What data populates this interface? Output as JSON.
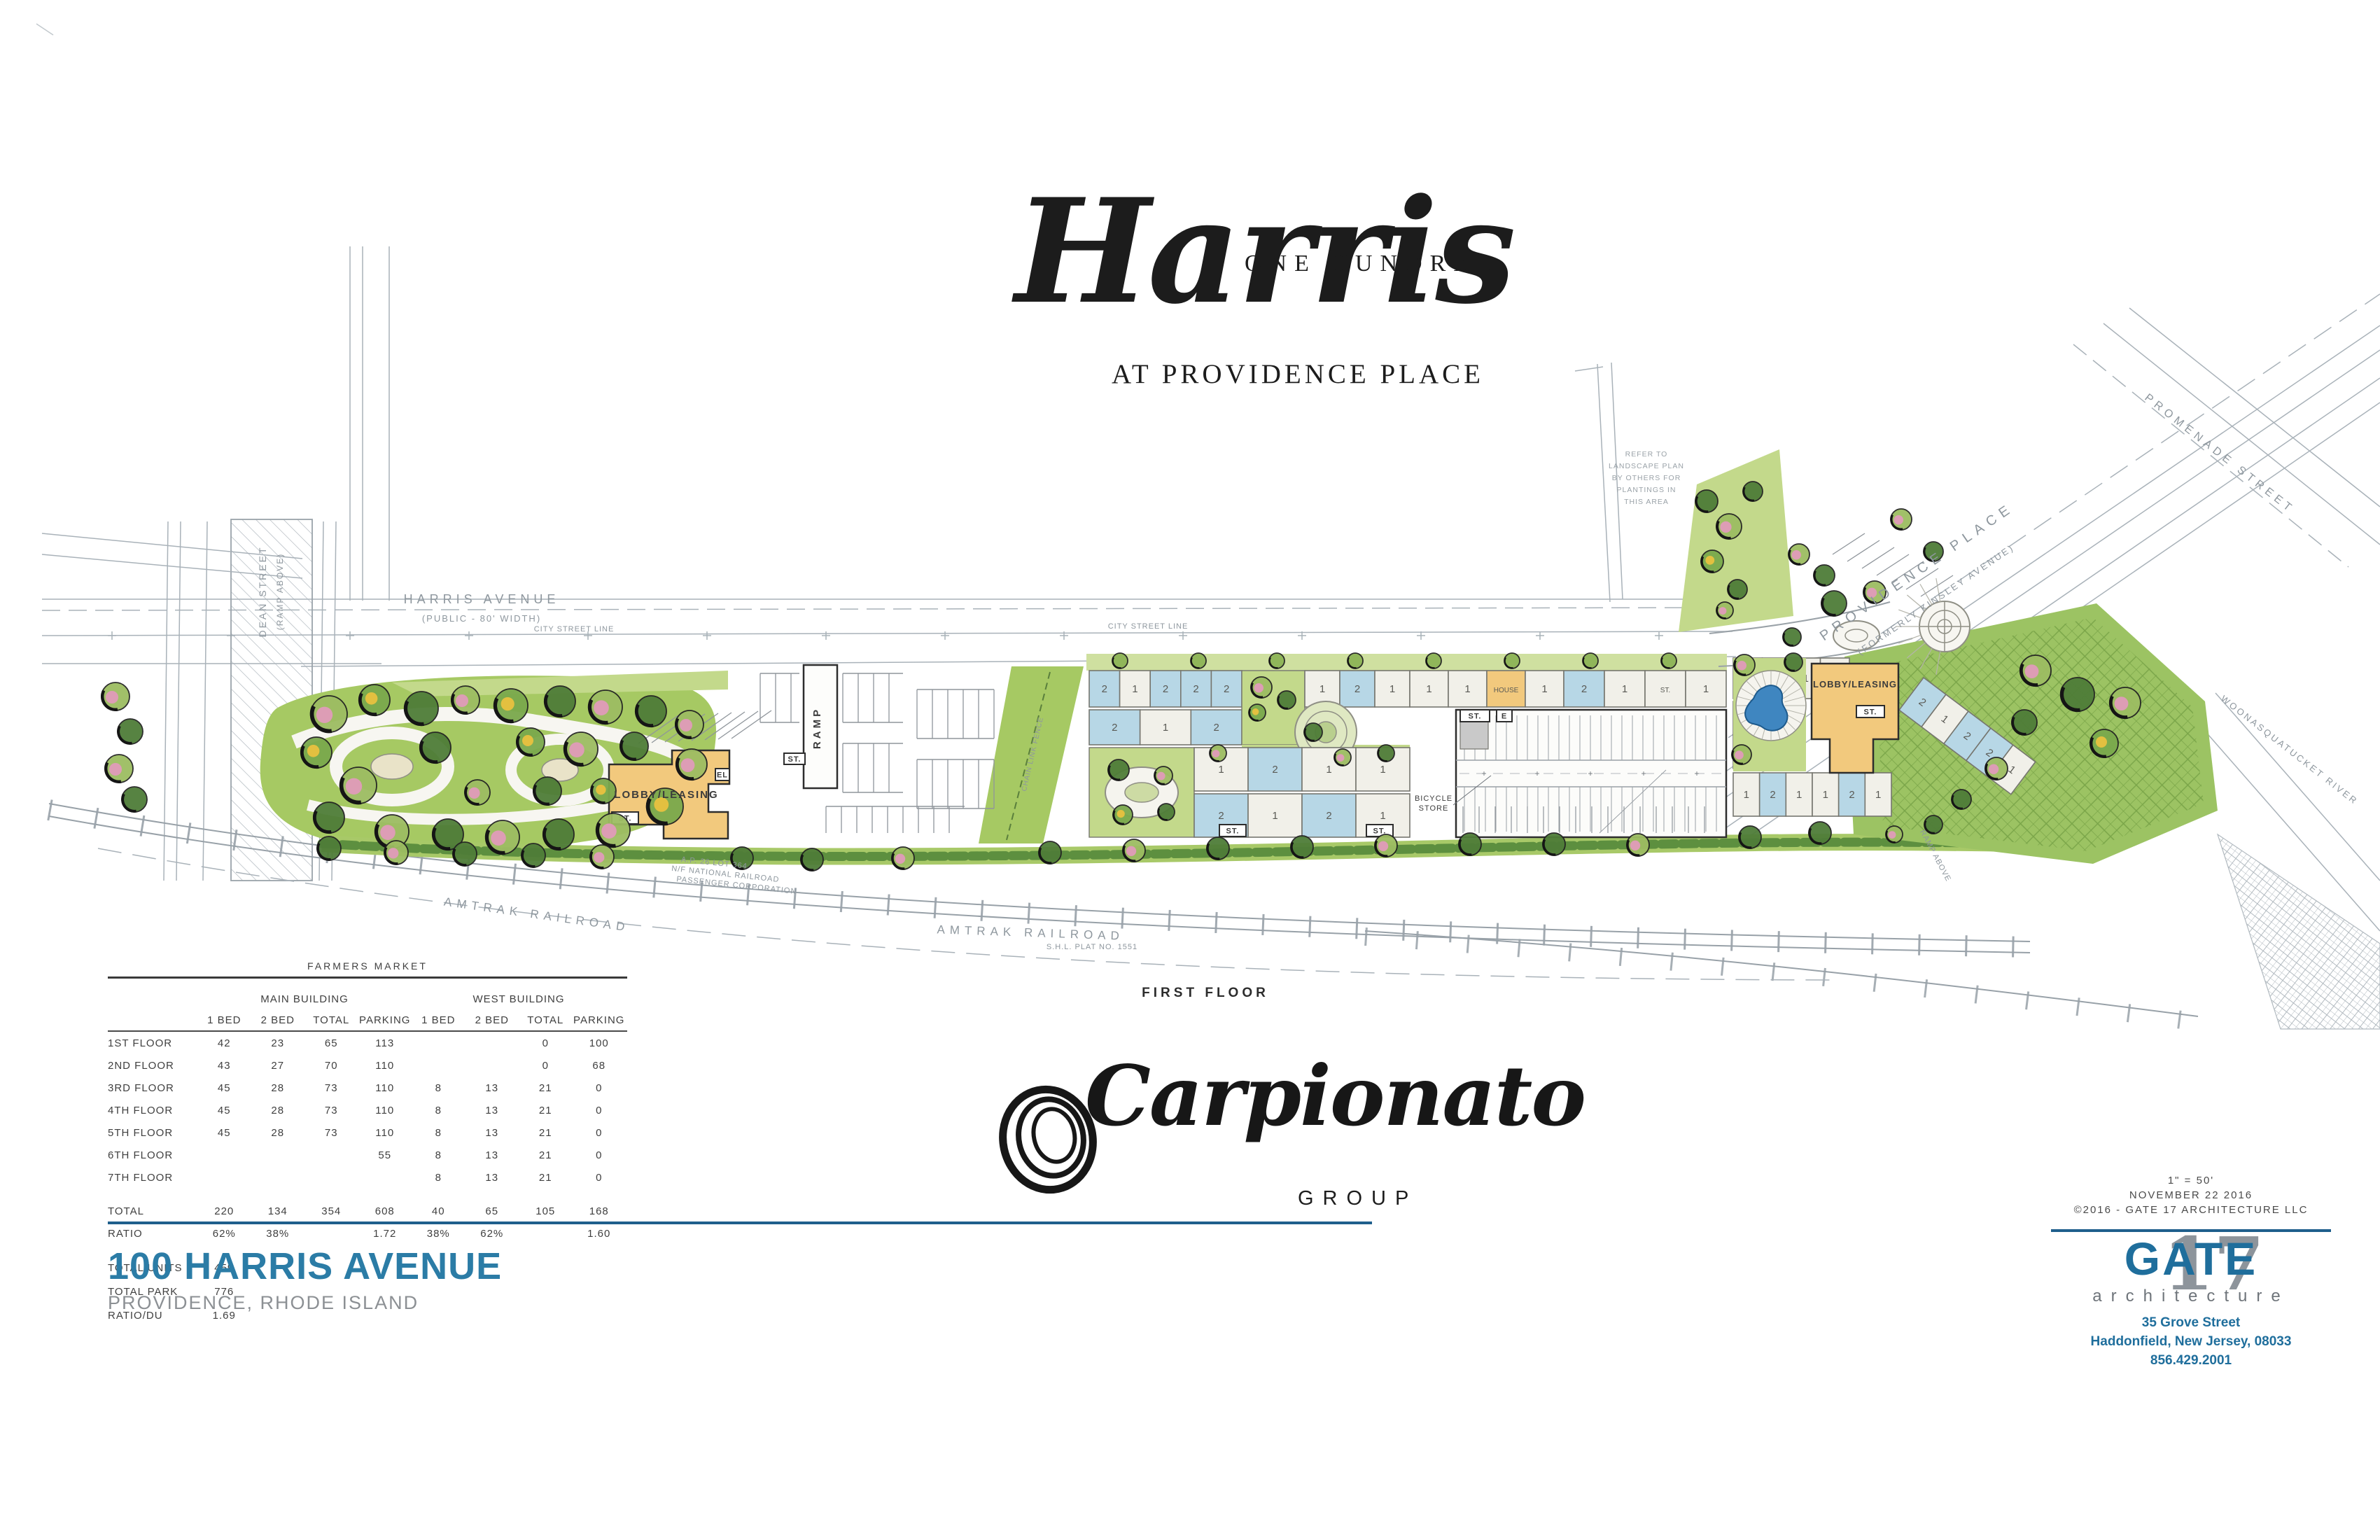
{
  "title": {
    "pre": "ONE HUNDRED",
    "main": "Harris",
    "sub": "AT PROVIDENCE PLACE"
  },
  "plan_labels": {
    "harris_avenue": "HARRIS AVENUE",
    "harris_avenue_sub": "(PUBLIC - 80' WIDTH)",
    "city_street_line": "CITY STREET LINE",
    "dean_street": "DEAN STREET",
    "dean_street_sub": "(RAMP ABOVE)",
    "providence_place": "PROVIDENCE PLACE",
    "providence_place_sub": "(FORMERLY KINSLEY AVENUE)",
    "promenade_street": "PROMENADE STREET",
    "woonasquatucket": "WOONASQUATUCKET RIVER",
    "amtrak_railroad": "AMTRAK RAILROAD",
    "railroad_lot": "A.P. 26 LOT 364",
    "railroad_owner1": "N/F NATIONAL RAILROAD",
    "railroad_owner2": "PASSENGER CORPORATION",
    "shl_plat": "S.H.L. PLAT NO. 1551",
    "chain_link_fence": "CHAIN LINK FENCE",
    "ramp_above": "RAMP ABOVE",
    "lobby_leasing": "LOBBY/LEASING",
    "ramp": "RAMP",
    "house": "HOUSE",
    "bicycle1": "BICYCLE",
    "bicycle2": "STORE",
    "st": "ST.",
    "el": "EL",
    "e": "E",
    "first_floor": "FIRST FLOOR",
    "landscape_note": [
      "REFER TO",
      "LANDSCAPE PLAN",
      "BY OTHERS FOR",
      "PLANTINGS IN",
      "THIS AREA"
    ]
  },
  "units": {
    "rowA": [
      "2",
      "1",
      "2",
      "2",
      "2"
    ],
    "rowB": [
      "1",
      "2",
      "1"
    ],
    "row2": [
      "2",
      "1",
      "2"
    ],
    "rowC": [
      "1",
      "1",
      "HOUSE",
      "1"
    ],
    "rowD": [
      "2",
      "1",
      "ST.",
      "1"
    ],
    "center_upper": [
      "1",
      "2",
      "1",
      "1"
    ],
    "center_lower": [
      "2",
      "1",
      "2",
      "1"
    ],
    "west_top": [
      "1",
      "2",
      "1",
      "1"
    ],
    "west_left": [
      "2",
      "1"
    ],
    "west_bottom": [
      "1",
      "2",
      "1",
      "1",
      "2",
      "1"
    ],
    "west_diag": [
      "2",
      "1",
      "2",
      "2",
      "1"
    ]
  },
  "unit_table": {
    "title": "FARMERS MARKET",
    "groups": [
      "MAIN BUILDING",
      "WEST BUILDING"
    ],
    "columns": [
      "1 BED",
      "2 BED",
      "TOTAL",
      "PARKING"
    ],
    "rows": [
      {
        "label": "1ST FLOOR",
        "main": [
          "42",
          "23",
          "65",
          "113"
        ],
        "west": [
          "",
          "",
          "0",
          "100"
        ]
      },
      {
        "label": "2ND FLOOR",
        "main": [
          "43",
          "27",
          "70",
          "110"
        ],
        "west": [
          "",
          "",
          "0",
          "68"
        ]
      },
      {
        "label": "3RD FLOOR",
        "main": [
          "45",
          "28",
          "73",
          "110"
        ],
        "west": [
          "8",
          "13",
          "21",
          "0"
        ]
      },
      {
        "label": "4TH FLOOR",
        "main": [
          "45",
          "28",
          "73",
          "110"
        ],
        "west": [
          "8",
          "13",
          "21",
          "0"
        ]
      },
      {
        "label": "5TH FLOOR",
        "main": [
          "45",
          "28",
          "73",
          "110"
        ],
        "west": [
          "8",
          "13",
          "21",
          "0"
        ]
      },
      {
        "label": "6TH FLOOR",
        "main": [
          "",
          "",
          "",
          "55"
        ],
        "west": [
          "8",
          "13",
          "21",
          "0"
        ]
      },
      {
        "label": "7TH FLOOR",
        "main": [
          "",
          "",
          "",
          ""
        ],
        "west": [
          "8",
          "13",
          "21",
          "0"
        ]
      }
    ],
    "totals": {
      "label": "TOTAL",
      "main": [
        "220",
        "134",
        "354",
        "608"
      ],
      "west": [
        "40",
        "65",
        "105",
        "168"
      ]
    },
    "ratio": {
      "label": "RATIO",
      "main": [
        "62%",
        "38%",
        "",
        "1.72"
      ],
      "west": [
        "38%",
        "62%",
        "",
        "1.60"
      ]
    },
    "summary": [
      {
        "label": "TOTAL UNITS",
        "value": "459"
      },
      {
        "label": "TOTAL PARK",
        "value": "776"
      },
      {
        "label": "RATIO/DU",
        "value": "1.69"
      }
    ]
  },
  "developer_logo": {
    "name": "Carpionato",
    "group": "GROUP"
  },
  "project_block": {
    "address": "100 HARRIS AVENUE",
    "city": "PROVIDENCE, RHODE ISLAND"
  },
  "architect_block": {
    "scale": "1\" = 50'",
    "date": "NOVEMBER 22 2016",
    "copyright": "©2016 - GATE 17 ARCHITECTURE LLC",
    "logo_main": "GATE",
    "logo_number": "17",
    "logo_sub": "architecture",
    "address_line1": "35 Grove Street",
    "address_line2": "Haddonfield, New Jersey, 08033",
    "phone": "856.429.2001"
  },
  "colors": {
    "title_teal": "#2b7ca6",
    "subtitle_gray": "#8c9094",
    "rule_blue": "#1f5f8c",
    "gate_blue": "#1f6e9c",
    "gate_gray": "#8d949b",
    "building_tan": "#f2c97d",
    "unit_blue": "#b7d7e6",
    "unit_white": "#f1f0e9",
    "site_green": "#a6c963",
    "tree_dark": "#4f7d38",
    "tree_pink": "#dd9db5",
    "tree_yellow": "#e3c040",
    "pool_blue": "#3f86c0",
    "linework": "#a9b2b9"
  }
}
